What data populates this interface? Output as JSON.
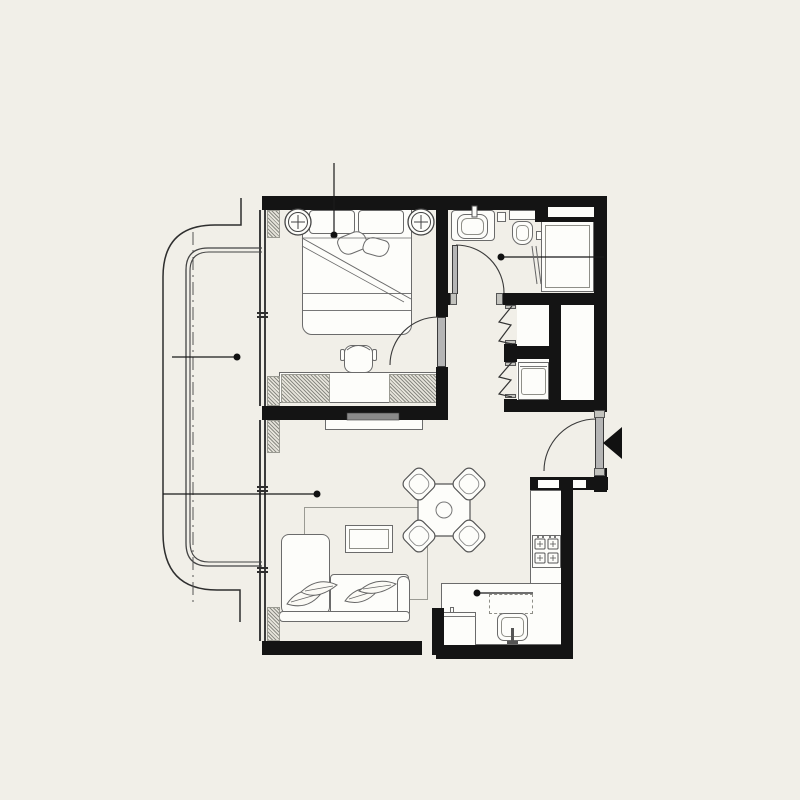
{
  "meta": {
    "kind": "apartment floor plan drawing",
    "style": "black-and-white architectural plan on cream background",
    "visible_text": "none"
  },
  "colors": {
    "background": "#f1efe8",
    "wall_fill": "#141414",
    "drawing_line": "#3c3c3c",
    "furniture_line": "#6b6b6b",
    "fixture_fill": "#fdfdfa",
    "door_leaf": "#b5b5b5",
    "marker_dot": "#111111"
  },
  "rooms": [
    {
      "name": "balcony",
      "features": [
        "curved outer edge",
        "double-line railing",
        "dash-dot roof line",
        "leader dot"
      ]
    },
    {
      "name": "bedroom",
      "features": [
        "double bed",
        "two round bedside lamps",
        "desk with chair",
        "hatched wardrobe counter",
        "window wall",
        "leader dot"
      ]
    },
    {
      "name": "bathroom",
      "features": [
        "washbasin",
        "toilet",
        "shower",
        "inward swinging door",
        "leader dot"
      ]
    },
    {
      "name": "hallway",
      "features": [
        "two bi-fold closets",
        "washing machine"
      ]
    },
    {
      "name": "shaft",
      "features": [
        "enclosed duct"
      ]
    },
    {
      "name": "entry",
      "features": [
        "entrance door with swing arc",
        "black entrance arrow"
      ]
    },
    {
      "name": "living-dining",
      "features": [
        "corner sofa with leaf pillows",
        "rug",
        "coffee table",
        "octagonal dining table",
        "four chairs",
        "tv bench",
        "leader dot"
      ]
    },
    {
      "name": "kitchen",
      "features": [
        "l-shaped counter",
        "4-burner stove",
        "sink",
        "appliance",
        "dashed upper cabinets",
        "leader dot"
      ]
    }
  ],
  "markers": {
    "leader_dots": [
      {
        "room": "bedroom",
        "x": 334,
        "y": 235
      },
      {
        "room": "balcony",
        "x": 237,
        "y": 357
      },
      {
        "room": "living-dining",
        "x": 317,
        "y": 494
      },
      {
        "room": "bathroom",
        "x": 501,
        "y": 257
      },
      {
        "room": "kitchen",
        "x": 477,
        "y": 593
      }
    ],
    "entrance_arrow": "black triangle pointing left at right wall"
  }
}
